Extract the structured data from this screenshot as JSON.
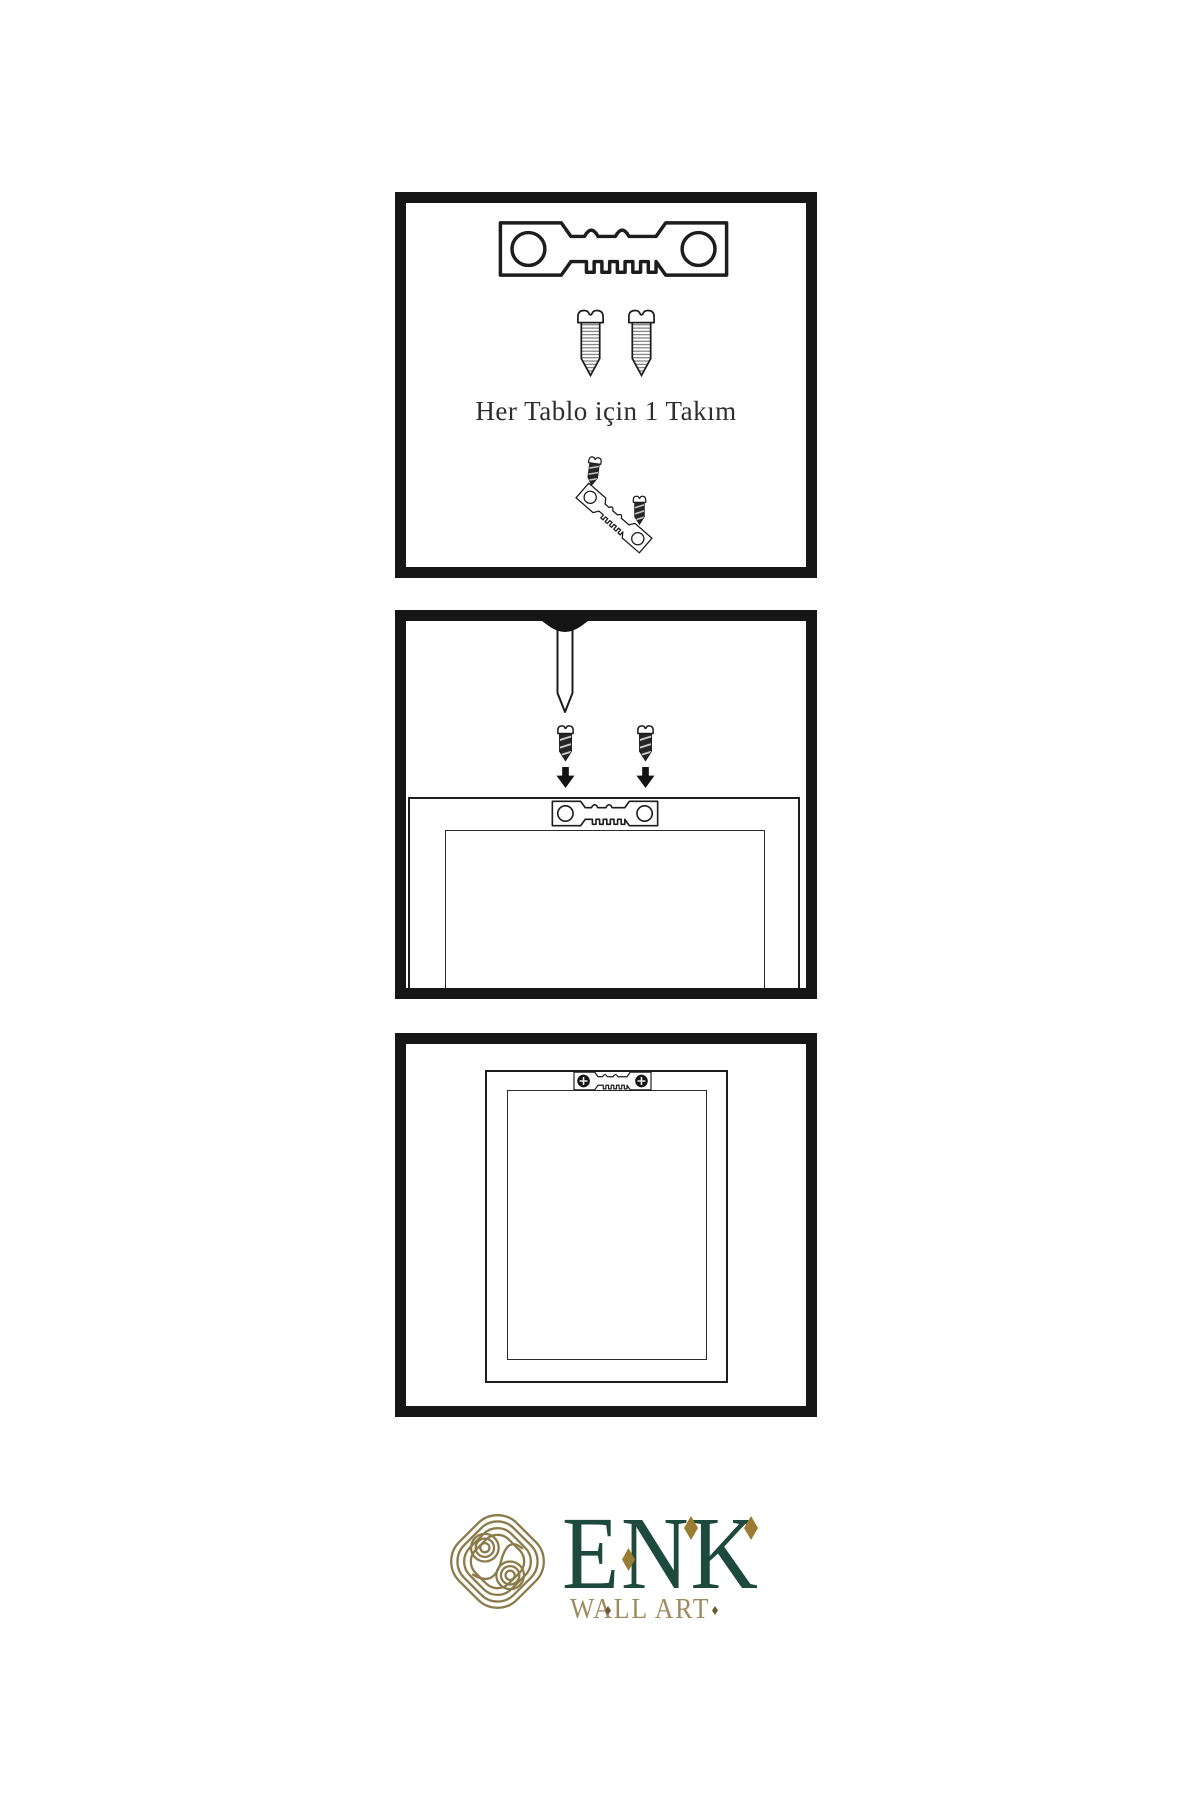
{
  "page": {
    "background": "#ffffff",
    "ink": "#1b1b1b"
  },
  "steps": {
    "kit": {
      "caption": "Her Tablo için 1 Takım"
    },
    "attach": {
      "caption": ""
    },
    "mounted": {
      "caption": ""
    }
  },
  "logo": {
    "title": "ENK",
    "subtitle": "WALL ART"
  },
  "colors": {
    "panel_border": "#161616",
    "line_ink": "#1d1d1d",
    "brand_green": "#1d4a3c",
    "brand_gold": "#9d8a5f",
    "knot_gold": "#8b7b4b",
    "diamond_gold": "#9a7c33"
  },
  "icons": [
    "sawtooth-hanger-icon",
    "screw-outline-icon",
    "screw-dark-icon",
    "nail-icon",
    "arrow-down-icon",
    "phillips-screwhead-icon",
    "celtic-knot-icon",
    "diamond-icon"
  ]
}
